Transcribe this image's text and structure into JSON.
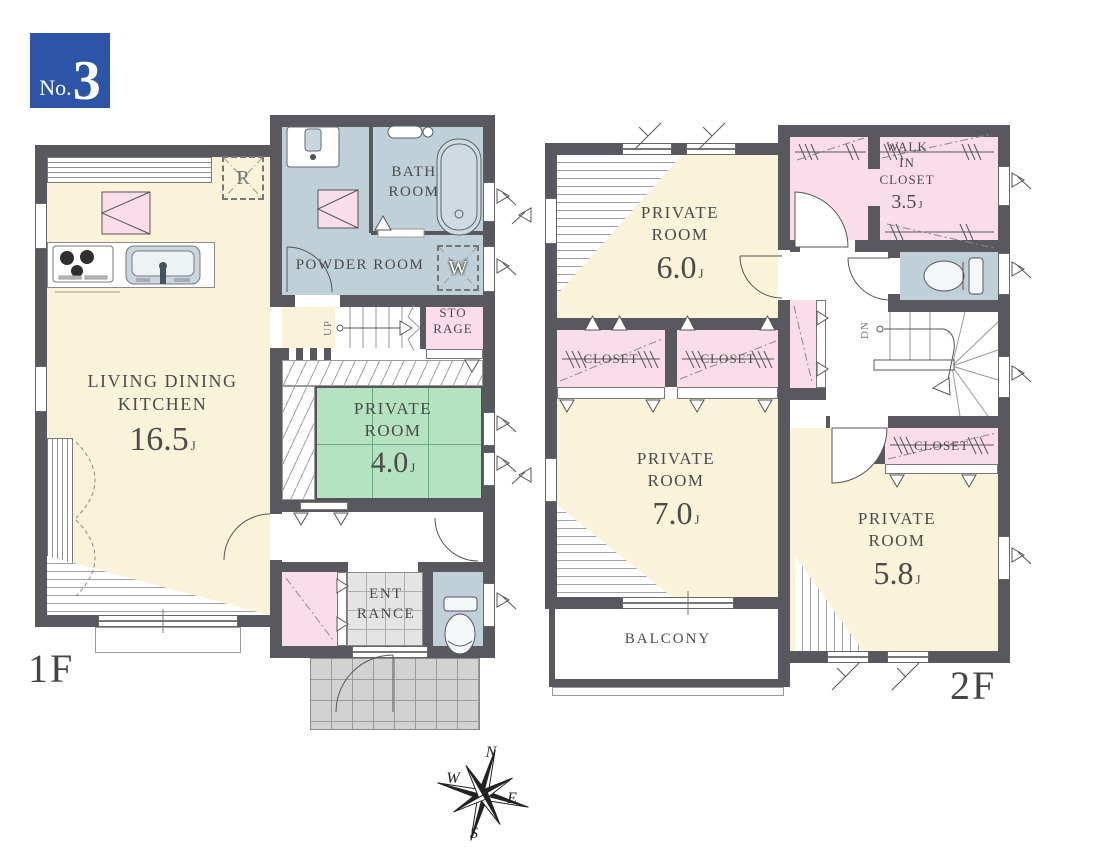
{
  "badge": {
    "prefix": "No.",
    "number": "3"
  },
  "compass": {
    "n": "N",
    "e": "E",
    "s": "S",
    "w": "W"
  },
  "floors": {
    "f1": {
      "label": "1F",
      "ldk": {
        "l1": "LIVING DINING",
        "l2": "KITCHEN",
        "size": "16.5",
        "unit": "J"
      },
      "bath": {
        "l1": "BATH",
        "l2": "ROOM"
      },
      "powder": {
        "label": "POWDER ROOM"
      },
      "washer": {
        "label": "W"
      },
      "fridge": {
        "label": "R"
      },
      "storage": {
        "l1": "STO",
        "l2": "RAGE"
      },
      "private4": {
        "l1": "PRIVATE",
        "l2": "ROOM",
        "size": "4.0",
        "unit": "J"
      },
      "entrance": {
        "l1": "ENT",
        "l2": "RANCE"
      },
      "stairs": {
        "label": "UP"
      }
    },
    "f2": {
      "label": "2F",
      "room6": {
        "l1": "PRIVATE",
        "l2": "ROOM",
        "size": "6.0",
        "unit": "J"
      },
      "room7": {
        "l1": "PRIVATE",
        "l2": "ROOM",
        "size": "7.0",
        "unit": "J"
      },
      "room58": {
        "l1": "PRIVATE",
        "l2": "ROOM",
        "size": "5.8",
        "unit": "J"
      },
      "wic": {
        "l1": "WALK",
        "l2": "IN",
        "l3": "CLOSET",
        "size": "3.5",
        "unit": "J"
      },
      "closet_a": {
        "label": "CLOSET"
      },
      "closet_b": {
        "label": "CLOSET"
      },
      "closet_c": {
        "label": "CLOSET"
      },
      "balcony": {
        "label": "BALCONY"
      },
      "stairs": {
        "label": "DN"
      }
    }
  },
  "colors": {
    "wall": "#5a585f",
    "cream": "#faf3da",
    "green": "#b5e3c0",
    "pink": "#fbdde9",
    "bluegray": "#c0d0d9",
    "badge_blue": "#2d55a7"
  }
}
